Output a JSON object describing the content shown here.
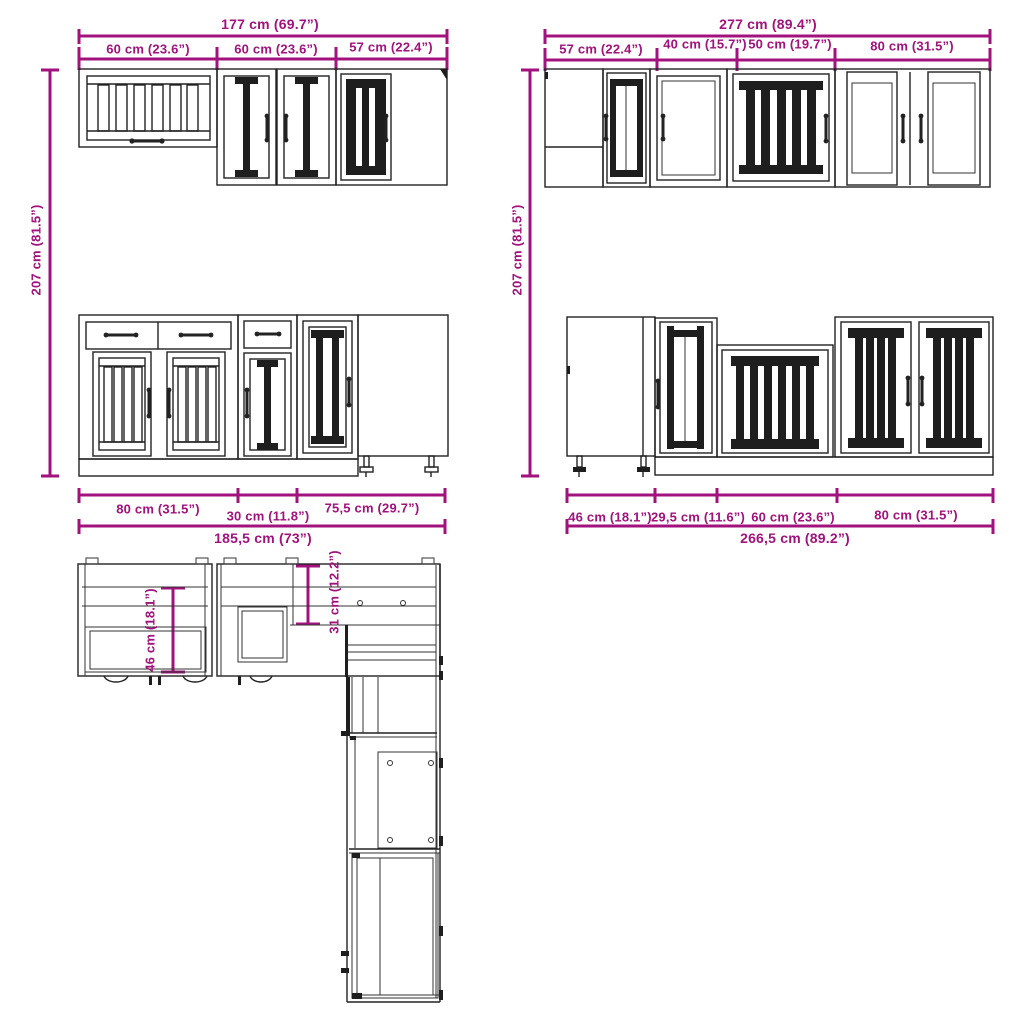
{
  "colors": {
    "dimension_accent": "#a1127c",
    "line": "#222222",
    "dark_fill": "#1e1e1e",
    "background": "#ffffff"
  },
  "wall_left": {
    "total_width": "177 cm (69.7”)",
    "segments": [
      "60 cm (23.6”)",
      "60 cm (23.6”)",
      "57 cm (22.4”)"
    ],
    "height": "207 cm (81.5”)"
  },
  "wall_right": {
    "total_width": "277 cm (89.4”)",
    "segments": [
      "57 cm (22.4”)",
      "40 cm (15.7”)",
      "50 cm (19.7”)",
      "80 cm (31.5”)"
    ],
    "height": "207 cm (81.5”)"
  },
  "base_left": {
    "segments": [
      "80 cm (31.5”)",
      "30 cm (11.8”)",
      "75,5 cm (29.7”)"
    ],
    "total_width": "185,5 cm (73”)"
  },
  "base_right": {
    "segments": [
      "46 cm (18.1”)",
      "29,5 cm (11.6”)",
      "60 cm (23.6”)",
      "80 cm (31.5”)"
    ],
    "total_width": "266,5 cm (89.2”)"
  },
  "plan_view": {
    "base_depth": "46 cm (18.1”)",
    "wall_depth": "31 cm (12.2”)"
  }
}
